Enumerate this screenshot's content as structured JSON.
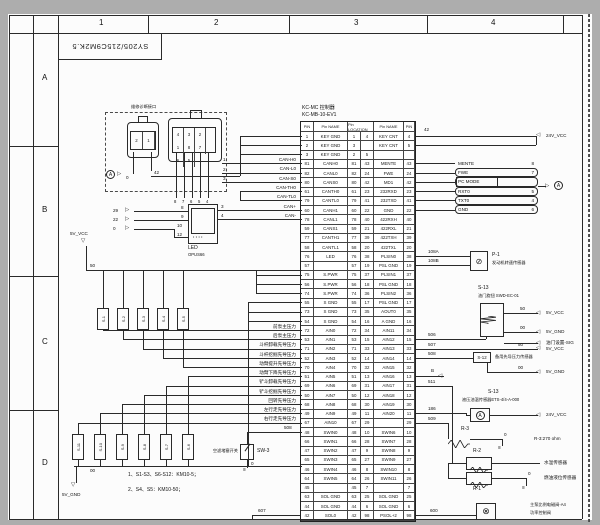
{
  "page": {
    "doc_title": "SY205/215C9M2K.5",
    "grid_cols": [
      "1",
      "2",
      "3",
      "4"
    ],
    "grid_rows": [
      "A",
      "B",
      "C",
      "D"
    ]
  },
  "controller": {
    "title_line1": "KC-MC 控制器",
    "title_line2": "KC-MB-10-EV1",
    "headers": [
      "PIN",
      "Pin NAME",
      "Pin LOCATION",
      "Pin NAME",
      "PIN"
    ],
    "rows": [
      [
        "1",
        "KEY GND",
        "1",
        "4",
        "KEY CNT",
        "4"
      ],
      [
        "2",
        "KEY GND",
        "3",
        "",
        "KEY CNT",
        "5"
      ],
      [
        "3",
        "KEY GND",
        "2",
        "5",
        "",
        ""
      ],
      [
        "81",
        "CANH0",
        "81",
        "43",
        "MENTE",
        "43"
      ],
      [
        "82",
        "CANL0",
        "82",
        "24",
        "FWE",
        "24"
      ],
      [
        "80",
        "CANS0",
        "80",
        "42",
        "MD1",
        "42"
      ],
      [
        "61",
        "CANTH0",
        "61",
        "23",
        "232RXD",
        "23"
      ],
      [
        "79",
        "CANTL0",
        "79",
        "41",
        "232TXD",
        "41"
      ],
      [
        "60",
        "CANH1",
        "60",
        "22",
        "GND",
        "22"
      ],
      [
        "78",
        "CANL1",
        "78",
        "40",
        "422RXH",
        "40"
      ],
      [
        "59",
        "CANS1",
        "59",
        "21",
        "422RXL",
        "21"
      ],
      [
        "77",
        "CANTH1",
        "77",
        "39",
        "422TXH",
        "39"
      ],
      [
        "58",
        "CANTL1",
        "58",
        "20",
        "422TXL",
        "20"
      ],
      [
        "76",
        "LED",
        "76",
        "38",
        "PLSIN0",
        "38"
      ],
      [
        "57",
        "",
        "57",
        "19",
        "PSL GND",
        "19"
      ],
      [
        "75",
        "S.PWR",
        "75",
        "37",
        "PLSIN1",
        "37"
      ],
      [
        "56",
        "S.PWR",
        "56",
        "18",
        "PSL GND",
        "18"
      ],
      [
        "74",
        "S.PWR",
        "74",
        "36",
        "PLSIN2",
        "36"
      ],
      [
        "55",
        "S GND",
        "55",
        "17",
        "PSL GND",
        "17"
      ],
      [
        "73",
        "S GND",
        "73",
        "35",
        "AOUT0",
        "35"
      ],
      [
        "54",
        "S GND",
        "54",
        "16",
        "A GND",
        "16"
      ],
      [
        "72",
        "AIN0",
        "72",
        "34",
        "AIN11",
        "34"
      ],
      [
        "53",
        "AIN1",
        "53",
        "15",
        "AIN12",
        "15"
      ],
      [
        "71",
        "AIN2",
        "71",
        "33",
        "AIN13",
        "33"
      ],
      [
        "52",
        "AIN3",
        "52",
        "14",
        "AIN14",
        "14"
      ],
      [
        "70",
        "AIN4",
        "70",
        "32",
        "AIN15",
        "32"
      ],
      [
        "51",
        "AIN5",
        "51",
        "13",
        "AIN16",
        "13"
      ],
      [
        "69",
        "AIN6",
        "69",
        "31",
        "AIN17",
        "31"
      ],
      [
        "50",
        "AIN7",
        "50",
        "12",
        "AIN18",
        "12"
      ],
      [
        "68",
        "AIN8",
        "68",
        "30",
        "AIN19",
        "30"
      ],
      [
        "49",
        "AIN9",
        "49",
        "11",
        "AIN20",
        "11"
      ],
      [
        "67",
        "AIN10",
        "67",
        "29",
        "",
        "29"
      ],
      [
        "48",
        "SWIN0",
        "48",
        "10",
        "SWIN6",
        "10"
      ],
      [
        "66",
        "SWIN1",
        "66",
        "28",
        "SWIN7",
        "28"
      ],
      [
        "47",
        "SWIN2",
        "47",
        "9",
        "SWIN8",
        "9"
      ],
      [
        "65",
        "SWIN3",
        "65",
        "27",
        "SWIN9",
        "27"
      ],
      [
        "46",
        "SWIN4",
        "46",
        "8",
        "SWIN10",
        "8"
      ],
      [
        "64",
        "SWIN5",
        "64",
        "26",
        "SWIN11",
        "26"
      ],
      [
        "45",
        "",
        "45",
        "7",
        "",
        "7"
      ],
      [
        "63",
        "SOL GND",
        "63",
        "25",
        "SOL GND",
        "25"
      ],
      [
        "44",
        "SOL GND",
        "44",
        "6",
        "SOL GND",
        "6"
      ],
      [
        "42",
        "SOL0",
        "42",
        "98",
        "PSOL+2",
        "98"
      ]
    ]
  },
  "diag": {
    "box_label": "维修诊断接口",
    "conn2_pins": [
      "2",
      "1"
    ],
    "conn8_row1": [
      "4",
      "3",
      "2",
      "1"
    ],
    "conn8_row2": [
      "8",
      "7",
      "6",
      "5"
    ],
    "conn2_wires": [
      "0",
      "42"
    ],
    "conn8_bottom_wires": [
      "8",
      "7",
      "6",
      "5",
      "4"
    ],
    "out_wires": [
      "1",
      "2",
      "3"
    ],
    "ref_a": "A"
  },
  "can": {
    "labels": [
      "CAN-H0",
      "CAN-L0",
      "CAN-S0",
      "CAN-TH0",
      "CAN-TL0",
      "CAN+",
      "CAN-"
    ]
  },
  "led": {
    "inputs": [
      "29",
      "22",
      "0"
    ],
    "pins_in": [
      "8",
      "9",
      "10",
      "12"
    ],
    "pins_out": [
      "3",
      "4"
    ],
    "name": "LED",
    "model": "OPUS66"
  },
  "power": {
    "v5": "5V_VCC",
    "bus50": "50",
    "bus00": "00",
    "g5": "5V_GND"
  },
  "sensors_top": [
    "S-1",
    "S-2",
    "S-3",
    "S-4",
    "S-5"
  ],
  "switches_bottom": [
    "S-11",
    "S-10",
    "S-9",
    "S-8",
    "S-7",
    "S-6"
  ],
  "signals": [
    {
      "name": "前泵主压力",
      "wire": "501"
    },
    {
      "name": "后泵主压力",
      "wire": "502"
    },
    {
      "name": "斗杆卸载先导压力",
      "wire": "202"
    },
    {
      "name": "斗杆挖掘先导压力",
      "wire": "203"
    },
    {
      "name": "动臂提升先导压力",
      "wire": "206"
    },
    {
      "name": "动臂下降先导压力",
      "wire": "207"
    },
    {
      "name": "铲斗卸载先导压力",
      "wire": "204"
    },
    {
      "name": "铲斗挖掘先导压力",
      "wire": "205"
    },
    {
      "name": "回转先导压力",
      "wire": "208"
    },
    {
      "name": "左行走先导压力",
      "wire": "200"
    },
    {
      "name": "右行走先导压力",
      "wire": "201"
    }
  ],
  "sw3": {
    "label": "空滤堵塞开关",
    "name": "SW-3",
    "wire": "508",
    "gnd": "0"
  },
  "notes": [
    "1、S1-S3、S6-S12：KM10-5；",
    "2、S4、S5：KM10-50；"
  ],
  "wire607": "607",
  "right": {
    "wire42": "42",
    "vcc24": "24V_VCC",
    "service_rows": [
      {
        "label": "MENTE",
        "pin": "8"
      },
      {
        "label": "FWE",
        "pin": "7"
      },
      {
        "label": "PC MODE",
        "pin": ""
      },
      {
        "label": "RXT0",
        "pin": "5"
      },
      {
        "label": "TXT0",
        "pin": "4"
      },
      {
        "label": "GND",
        "pin": "6"
      }
    ],
    "ref_a": "A",
    "p1": {
      "wire_a": "108A",
      "wire_b": "108B",
      "name": "P-1",
      "label": "发动机转速传感器"
    },
    "throttle": {
      "name": "S-13",
      "label": "油门旋钮 SWD-EC-01",
      "w50": "50",
      "w00": "00",
      "vcc": "5V_VCC",
      "gnd": "5V_GND"
    },
    "sig_label": "油门设置-SIG",
    "w506": "506",
    "w507": "507",
    "w508": "508",
    "s12": {
      "name": "S-12",
      "label": "备用先导压力传感器",
      "w50": "50",
      "vcc": "5V_VCC",
      "w00": "00",
      "gnd": "5V_GND"
    },
    "wB": "B",
    "w511": "511",
    "w186": "186",
    "w509": "509",
    "ets": {
      "name": "S-13",
      "label": "液压油温传感器ETS-4/4-A-000",
      "vcc": "24V_VCC"
    },
    "r3": {
      "name": "R-3",
      "gnd": "0",
      "value": "R-3:270 ohm"
    },
    "r2": {
      "name": "R-2",
      "label": "水温传感器"
    },
    "r1": {
      "name": "R-1",
      "label": "燃油液位传感器",
      "gnd": "0"
    },
    "w600": "600",
    "solenoid": {
      "label1": "主泵比例电磁阀-A4",
      "label2": "功率控制阀"
    }
  }
}
